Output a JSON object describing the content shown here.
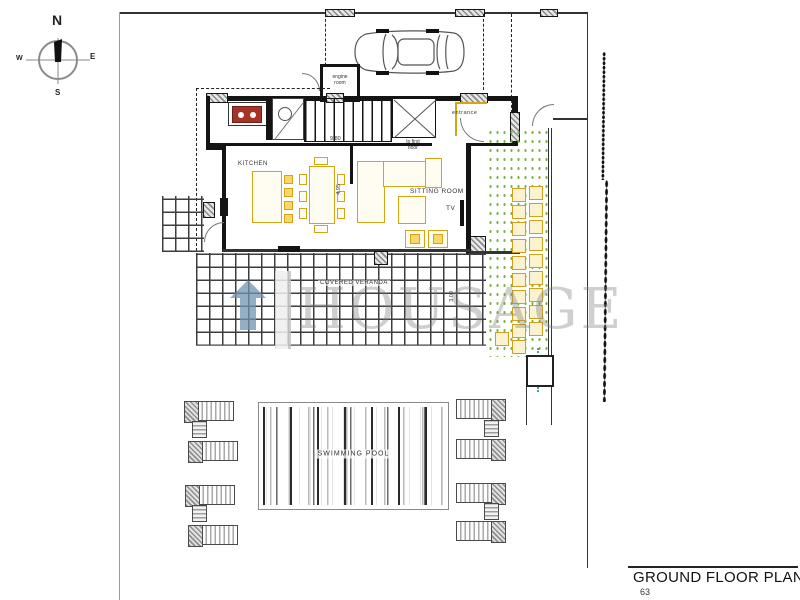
{
  "compass": {
    "n": "N",
    "e": "E",
    "s": "S",
    "w": "W"
  },
  "labels": {
    "engine_room": "engine\nroom",
    "entrance": "entrance",
    "to_first_floor": "to first\nfloor",
    "kitchen": "KITCHEN",
    "sitting_room": "SITTING ROOM",
    "tv": "TV",
    "covered_veranda": "COVERED VERANDA",
    "swimming_pool": "SWIMMING POOL"
  },
  "dimensions": {
    "house_width": "9.80",
    "kitchen_depth": "4.95",
    "sitting_depth": "4.55",
    "veranda_depth": "3.00"
  },
  "watermark": {
    "text": "HOUSAGE"
  },
  "title_block": {
    "title": "GROUND FLOOR PLAN",
    "area": "63 s.m."
  },
  "colors": {
    "furniture_gold": "#D7A514",
    "stove_red": "#A93226",
    "garden_green": "#7CB342",
    "logo_blue": "#7293B0",
    "pool_path_teal": "#4AA0A0"
  }
}
